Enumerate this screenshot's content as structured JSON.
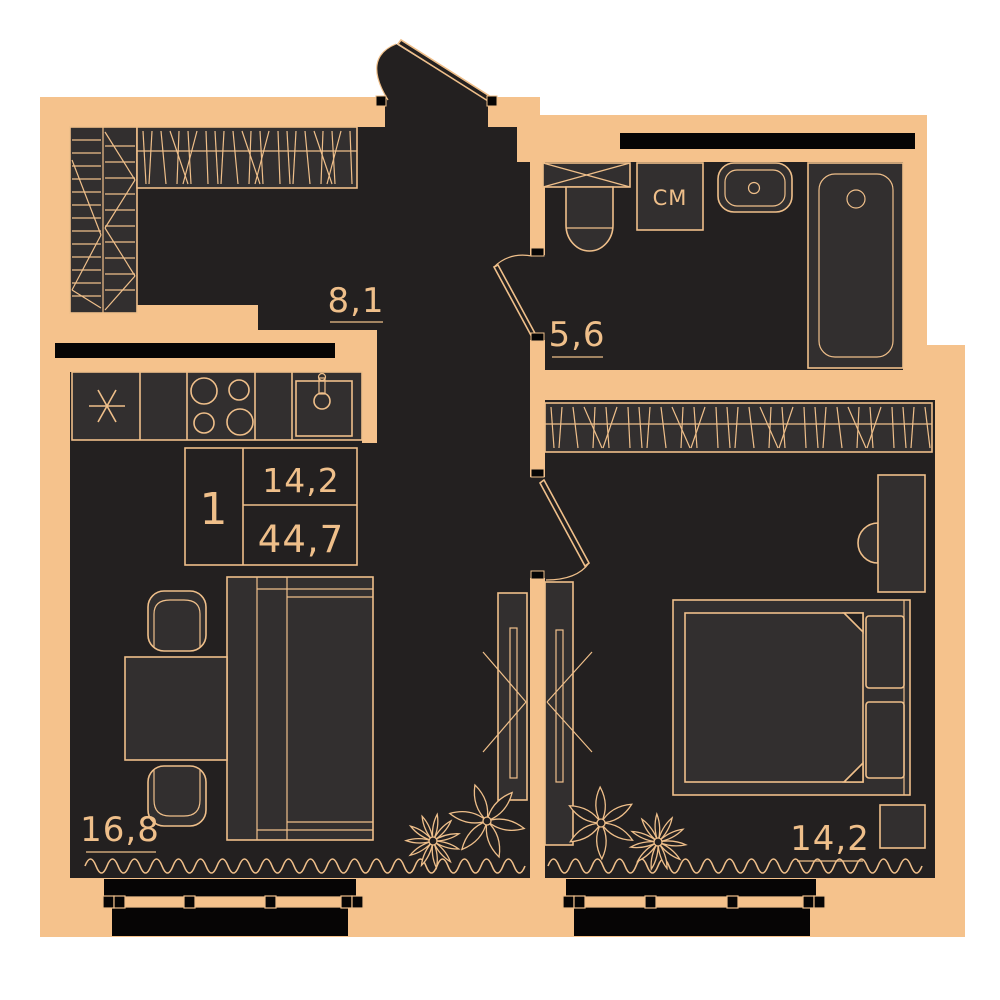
{
  "labels": {
    "hallway_area": "8,1",
    "bathroom_area": "5,6",
    "living_room_area": "16,8",
    "bedroom_area": "14,2",
    "washing_machine": "СМ"
  },
  "info_box": {
    "rooms_count": "1",
    "living_area": "14,2",
    "total_area": "44,7"
  },
  "colors": {
    "wall": "#f5c28c",
    "line": "#efbf8a",
    "room": "#232020",
    "furn": "#322f2f",
    "black": "#060505",
    "bg": "#ffffff"
  }
}
